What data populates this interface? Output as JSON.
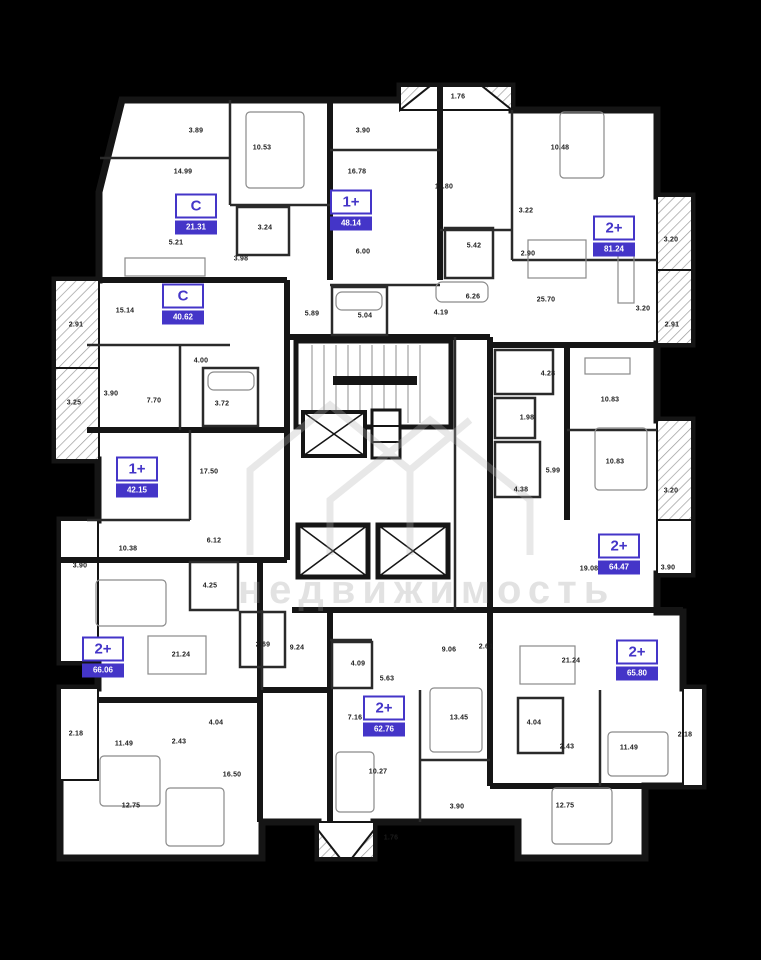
{
  "watermark": {
    "text": "недвижимость"
  },
  "colors": {
    "accent": "#4435c8",
    "wall": "#151515",
    "floor": "#ffffff",
    "background": "#000000"
  },
  "apartments": [
    {
      "type": "C",
      "area": "21.31",
      "x": 196,
      "y": 214
    },
    {
      "type": "1+",
      "area": "48.14",
      "x": 351,
      "y": 210
    },
    {
      "type": "2+",
      "area": "81.24",
      "x": 614,
      "y": 236
    },
    {
      "type": "C",
      "area": "40.62",
      "x": 183,
      "y": 304
    },
    {
      "type": "1+",
      "area": "42.15",
      "x": 137,
      "y": 477
    },
    {
      "type": "2+",
      "area": "64.47",
      "x": 619,
      "y": 554
    },
    {
      "type": "2+",
      "area": "66.06",
      "x": 103,
      "y": 657
    },
    {
      "type": "2+",
      "area": "62.76",
      "x": 384,
      "y": 716
    },
    {
      "type": "2+",
      "area": "65.80",
      "x": 637,
      "y": 660
    }
  ],
  "measurements": [
    {
      "v": "3.89",
      "x": 196,
      "y": 131
    },
    {
      "v": "10.53",
      "x": 262,
      "y": 148
    },
    {
      "v": "14.99",
      "x": 183,
      "y": 172
    },
    {
      "v": "3.24",
      "x": 265,
      "y": 228
    },
    {
      "v": "5.21",
      "x": 176,
      "y": 243
    },
    {
      "v": "3.98",
      "x": 241,
      "y": 259
    },
    {
      "v": "3.90",
      "x": 363,
      "y": 131
    },
    {
      "v": "16.78",
      "x": 357,
      "y": 172
    },
    {
      "v": "6.00",
      "x": 363,
      "y": 252
    },
    {
      "v": "5.89",
      "x": 312,
      "y": 314
    },
    {
      "v": "5.04",
      "x": 365,
      "y": 316
    },
    {
      "v": "1.76",
      "x": 458,
      "y": 97
    },
    {
      "v": "11.80",
      "x": 444,
      "y": 187
    },
    {
      "v": "10.48",
      "x": 560,
      "y": 148
    },
    {
      "v": "3.22",
      "x": 526,
      "y": 211
    },
    {
      "v": "5.42",
      "x": 474,
      "y": 246
    },
    {
      "v": "2.90",
      "x": 528,
      "y": 254
    },
    {
      "v": "3.20",
      "x": 671,
      "y": 240
    },
    {
      "v": "6.26",
      "x": 473,
      "y": 297
    },
    {
      "v": "25.70",
      "x": 546,
      "y": 300
    },
    {
      "v": "4.19",
      "x": 441,
      "y": 313
    },
    {
      "v": "3.20",
      "x": 643,
      "y": 309
    },
    {
      "v": "2.91",
      "x": 672,
      "y": 325
    },
    {
      "v": "2.91",
      "x": 76,
      "y": 325
    },
    {
      "v": "15.14",
      "x": 125,
      "y": 311
    },
    {
      "v": "3.90",
      "x": 111,
      "y": 394
    },
    {
      "v": "7.70",
      "x": 154,
      "y": 401
    },
    {
      "v": "4.00",
      "x": 201,
      "y": 361
    },
    {
      "v": "3.72",
      "x": 222,
      "y": 404
    },
    {
      "v": "3.25",
      "x": 74,
      "y": 403
    },
    {
      "v": "17.50",
      "x": 209,
      "y": 472
    },
    {
      "v": "6.12",
      "x": 214,
      "y": 541
    },
    {
      "v": "10.38",
      "x": 128,
      "y": 549
    },
    {
      "v": "4.28",
      "x": 548,
      "y": 374
    },
    {
      "v": "10.83",
      "x": 610,
      "y": 400
    },
    {
      "v": "1.98",
      "x": 527,
      "y": 418
    },
    {
      "v": "5.99",
      "x": 553,
      "y": 471
    },
    {
      "v": "10.83",
      "x": 615,
      "y": 462
    },
    {
      "v": "4.38",
      "x": 521,
      "y": 490
    },
    {
      "v": "3.20",
      "x": 671,
      "y": 491
    },
    {
      "v": "19.08",
      "x": 589,
      "y": 569
    },
    {
      "v": "3.90",
      "x": 668,
      "y": 568
    },
    {
      "v": "3.90",
      "x": 80,
      "y": 566
    },
    {
      "v": "4.25",
      "x": 210,
      "y": 586
    },
    {
      "v": "21.24",
      "x": 181,
      "y": 655
    },
    {
      "v": "2.69",
      "x": 263,
      "y": 645
    },
    {
      "v": "9.24",
      "x": 297,
      "y": 648
    },
    {
      "v": "2.18",
      "x": 76,
      "y": 734
    },
    {
      "v": "11.49",
      "x": 124,
      "y": 744
    },
    {
      "v": "2.43",
      "x": 179,
      "y": 742
    },
    {
      "v": "4.04",
      "x": 216,
      "y": 723
    },
    {
      "v": "16.50",
      "x": 232,
      "y": 775
    },
    {
      "v": "12.75",
      "x": 131,
      "y": 806
    },
    {
      "v": "4.09",
      "x": 358,
      "y": 664
    },
    {
      "v": "5.63",
      "x": 387,
      "y": 679
    },
    {
      "v": "9.06",
      "x": 449,
      "y": 650
    },
    {
      "v": "2.61",
      "x": 486,
      "y": 647
    },
    {
      "v": "7.16",
      "x": 355,
      "y": 718
    },
    {
      "v": "13.45",
      "x": 459,
      "y": 718
    },
    {
      "v": "10.27",
      "x": 378,
      "y": 772
    },
    {
      "v": "3.90",
      "x": 457,
      "y": 807
    },
    {
      "v": "1.76",
      "x": 391,
      "y": 838
    },
    {
      "v": "21.24",
      "x": 571,
      "y": 661
    },
    {
      "v": "4.04",
      "x": 534,
      "y": 723
    },
    {
      "v": "2.43",
      "x": 567,
      "y": 747
    },
    {
      "v": "11.49",
      "x": 629,
      "y": 748
    },
    {
      "v": "2.18",
      "x": 685,
      "y": 735
    },
    {
      "v": "12.75",
      "x": 565,
      "y": 806
    }
  ]
}
